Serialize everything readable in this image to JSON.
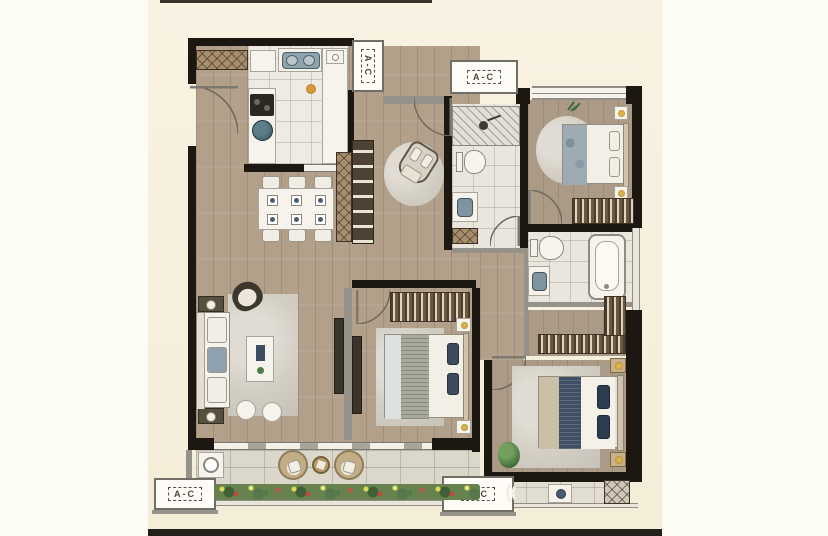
{
  "plan": {
    "title": "apartment-floor-plan",
    "ac_units": [
      {
        "position": "top-left-platform",
        "label": "A-C"
      },
      {
        "position": "top-center-platform",
        "label": "A-C"
      },
      {
        "position": "bottom-left-platform",
        "label": "A-C"
      },
      {
        "position": "bottom-right-platform",
        "label": "A-C"
      }
    ],
    "colors": {
      "page_background": "#fcfbf4",
      "plan_background": "#f6efdc",
      "wall": "#1d1711",
      "wood_floor": "#b2a08b",
      "tile_floor": "#eae6dd",
      "balcony_tile": "#dbd7cb",
      "accent_navy": "#3c4d61",
      "accent_blue": "#9fabb2",
      "greenery": "#4e7a4a",
      "gold": "#d9b34b"
    }
  }
}
